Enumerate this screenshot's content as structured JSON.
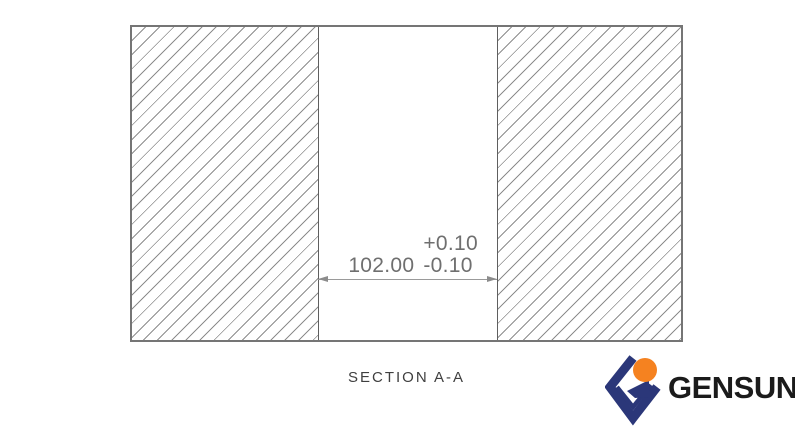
{
  "drawing": {
    "section_label": "SECTION A-A",
    "dimension": {
      "value": "102.00",
      "tolerance_plus": "+0.10",
      "tolerance_minus": "-0.10"
    }
  },
  "logo": {
    "text": "GENSUN",
    "mark_navy": "#2b3779",
    "mark_orange": "#f58220"
  },
  "colors": {
    "outline": "#757575",
    "bore_edge": "#5f5f5f",
    "hatch_line": "#8d8d8d",
    "dimension_line": "#9a9a9a",
    "dimension_text": "#6f6f6f",
    "section_label": "#3f3f3f",
    "logo_text": "#1b1b1b"
  }
}
